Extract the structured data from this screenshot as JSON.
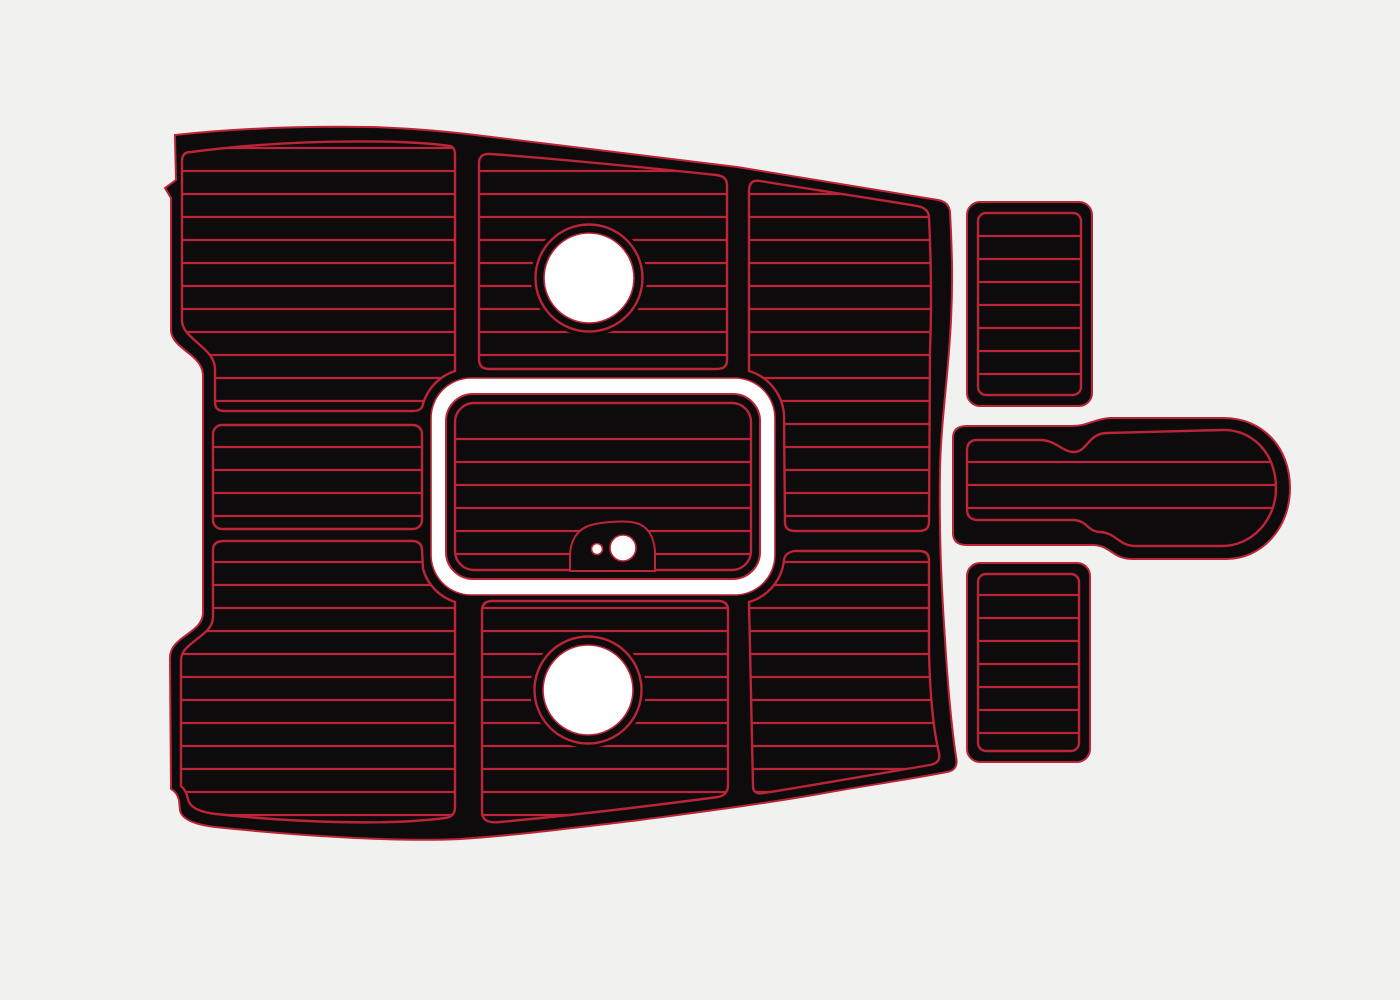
{
  "figure": {
    "kind": "product-template-illustration",
    "description": "CNC-cut EVA foam boat cockpit and swim platform pad set, black foam with red routed faux-teak groove lines on a light gray background",
    "pad_color_name": "black",
    "groove_color_name": "red",
    "pieces": [
      {
        "name": "main-cockpit-pad",
        "features": [
          "curved bow-shaped outline",
          "three plank columns with abutting seams",
          "white gap ring around center engine hatch",
          "upper round hatch cutout",
          "lower round hatch cutout",
          "notched left waist edge",
          "swept lower-right edge"
        ]
      },
      {
        "name": "engine-hatch-pad",
        "features": [
          "rounded rectangle",
          "keyhole latch cutout with two round holes"
        ]
      },
      {
        "name": "top-right-step-pad",
        "features": [
          "vertical rounded rectangle",
          "7 plank lines"
        ]
      },
      {
        "name": "middle-right-step-pad",
        "features": [
          "horizontal paddle shape with stepped neck and rounded right cap",
          "3 plank lines"
        ]
      },
      {
        "name": "bottom-right-step-pad",
        "features": [
          "vertical rounded rectangle",
          "7 plank lines"
        ]
      }
    ],
    "plank_pitch_px": 23,
    "round_hatch_hole_radius_px": 45,
    "round_hatch_ring_radius_px": 53.5
  },
  "colors": {
    "background": "#f1f1ef",
    "pad_black": "#0d0b0c",
    "groove_red": "#bc2438",
    "cut_white": "#ffffff"
  }
}
